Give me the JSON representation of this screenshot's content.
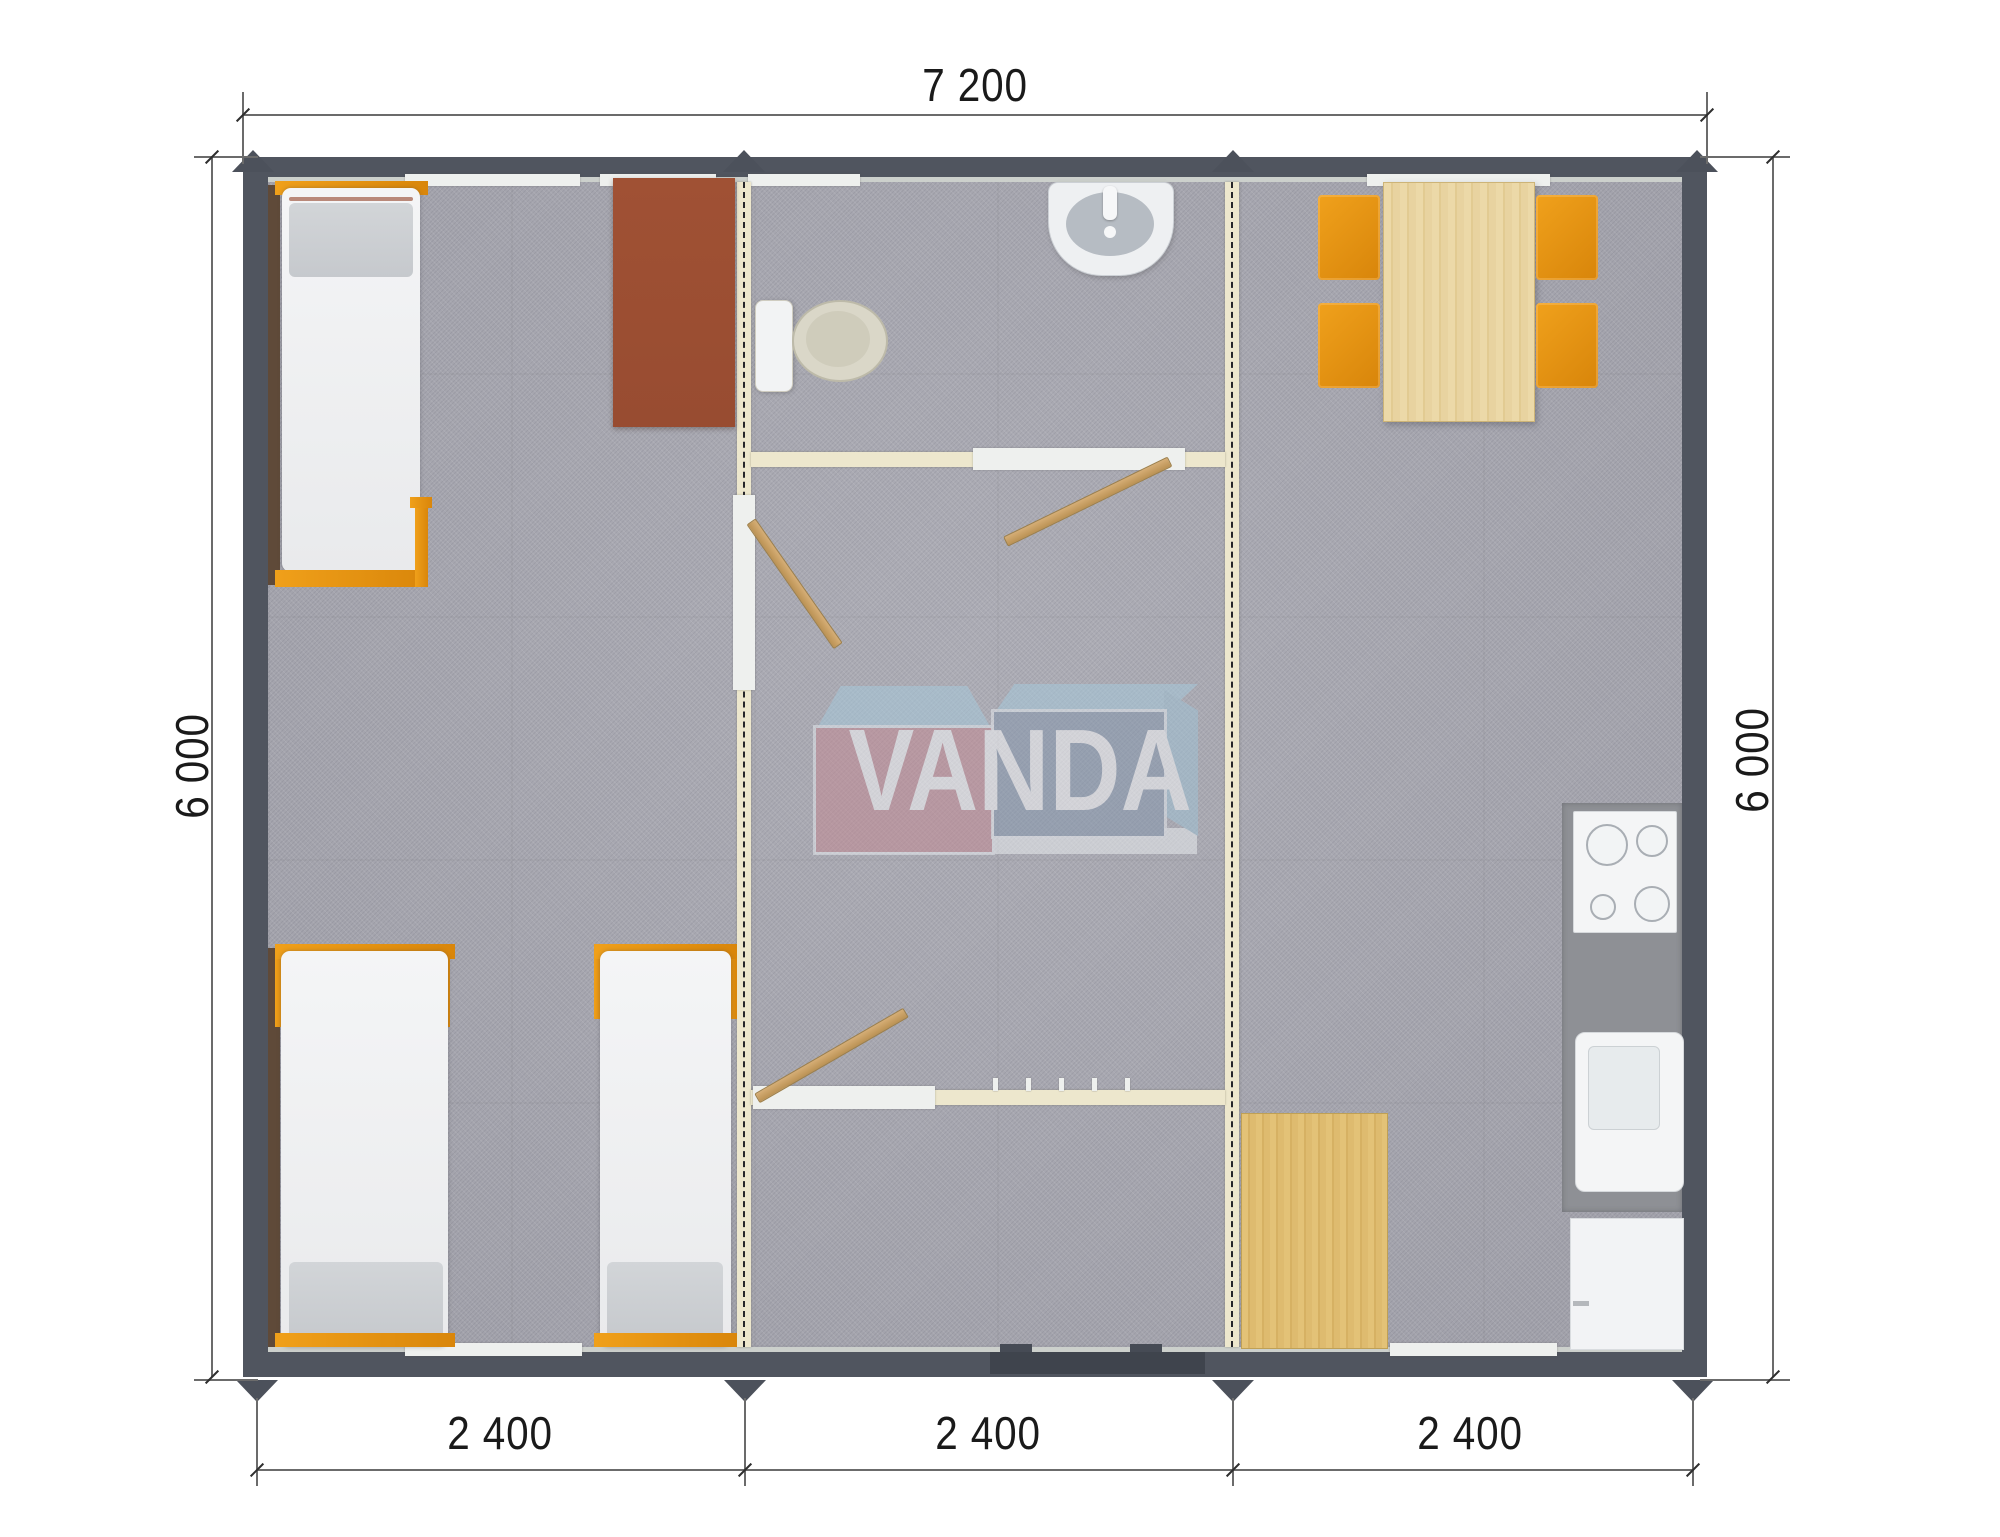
{
  "document": {
    "type": "floor-plan",
    "units": "mm"
  },
  "dimensions": {
    "top_width": "7 200",
    "left_height": "6 000",
    "right_height": "6 000",
    "bottom_segments": [
      "2 400",
      "2 400",
      "2 400"
    ]
  },
  "logo": {
    "text": "VANDA"
  },
  "colors": {
    "wall": "#50555f",
    "module_joint_wall": "#ede7cd",
    "floor": "#a8a8b1",
    "accent_orange": "#e3920c",
    "wood": "#dfbd72",
    "wardrobe_brown": "#9d4f33",
    "counter_gray": "#8e9095",
    "logo_red": "#c48791",
    "logo_blue": "#8396ad",
    "logo_light_blue": "#a6cbde"
  },
  "furniture": [
    "single-bed",
    "single-bed",
    "single-bed",
    "wardrobe",
    "toilet",
    "wash-basin",
    "interior-door",
    "interior-door",
    "interior-door",
    "coat-hooks",
    "entrance-door",
    "dining-table",
    "chair",
    "chair",
    "chair",
    "chair",
    "kitchen-counter",
    "cooktop",
    "kitchen-sink",
    "cabinet",
    "floor-mat"
  ]
}
